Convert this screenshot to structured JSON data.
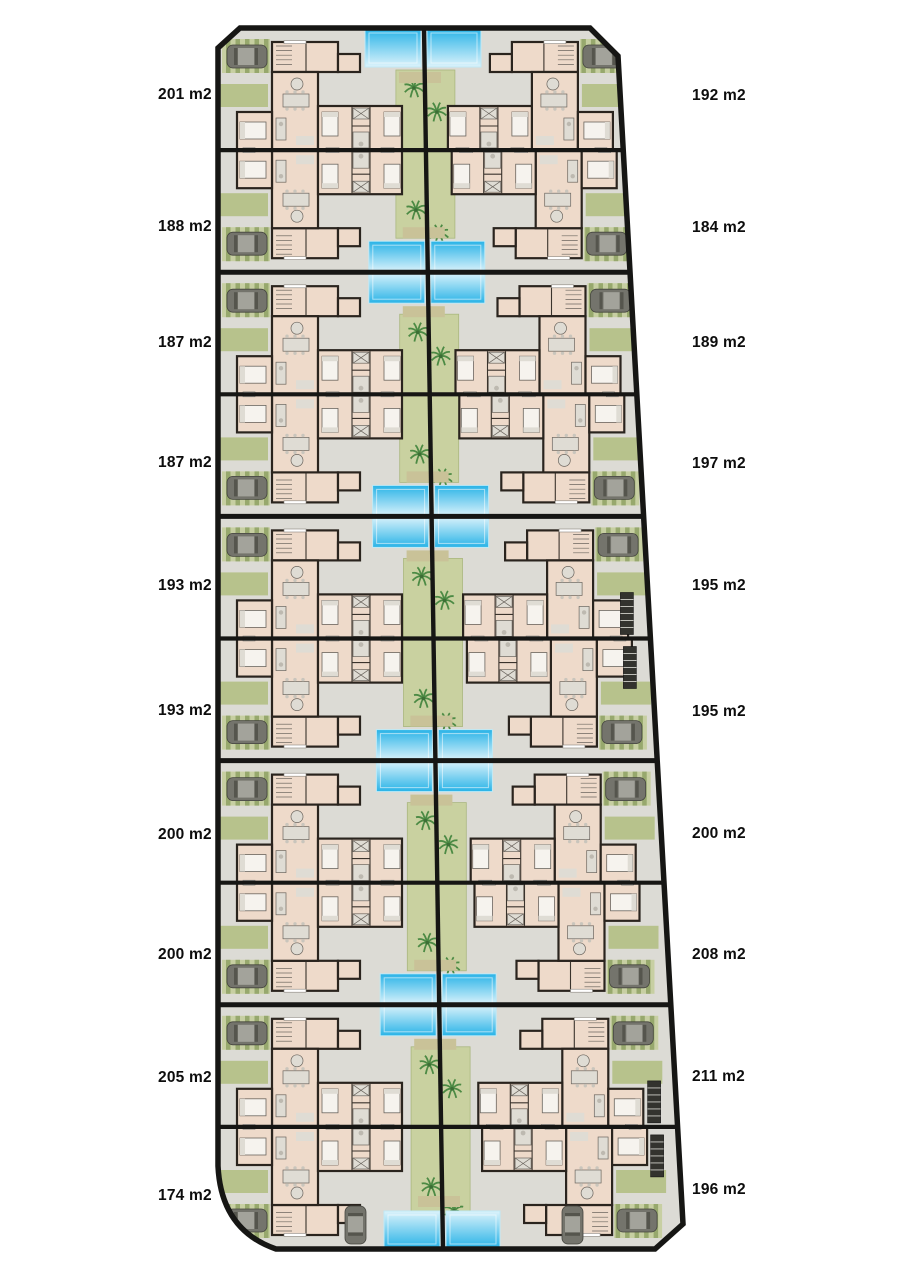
{
  "page": {
    "width": 905,
    "height": 1280,
    "background": "#ffffff"
  },
  "plan": {
    "type": "residential-site-plan",
    "rows": 10,
    "units_per_row": 2,
    "left_labels": [
      "201 m2",
      "188 m2",
      "187 m2",
      "187 m2",
      "193 m2",
      "193 m2",
      "200 m2",
      "200 m2",
      "205 m2",
      "174 m2"
    ],
    "right_labels": [
      "192 m2",
      "184 m2",
      "189 m2",
      "197 m2",
      "195 m2",
      "195 m2",
      "200 m2",
      "208 m2",
      "211 m2",
      "196 m2"
    ],
    "colors": {
      "paving": "#dcdbd5",
      "outline": "#161614",
      "unit_fill": "#eedaca",
      "unit_wall": "#2a241e",
      "green_path": "#c9d1a0",
      "green_path_edge": "#aab77f",
      "garden_pad": "#b7c28c",
      "car_pad": "#c7cfa2",
      "car_pad_stripe": "#97a86d",
      "pool_deep": "#29b3e7",
      "pool_light": "#dcf3fb",
      "pool_trim": "#bfe9f6",
      "pool_end_pad": "#c9c298",
      "palm": "#4c8a44",
      "palm_dark": "#3c6e35",
      "car_body": "#74746c",
      "car_roof": "#a3a39b",
      "car_glass": "#55554d",
      "furniture": "#dfdcd4",
      "furniture_line": "#6b655e",
      "bed_white": "#f6f3ee",
      "pergola": "#33332e",
      "pergola_slat": "#cfcfc8",
      "window_white": "#ffffff",
      "label_text": "#0d0d0d"
    }
  }
}
